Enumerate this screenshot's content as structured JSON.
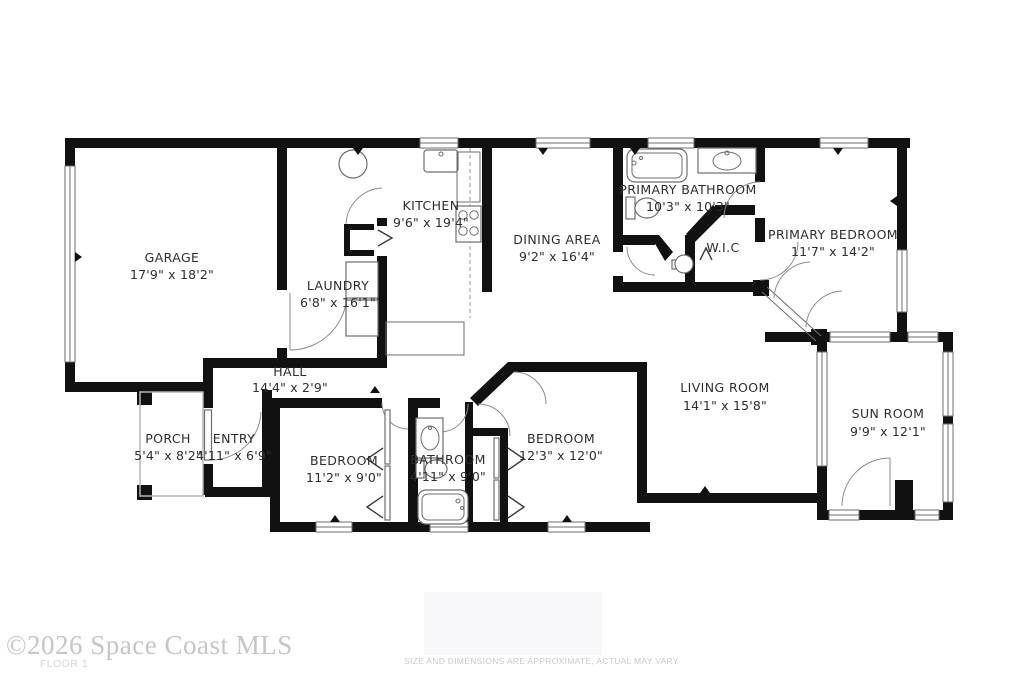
{
  "rooms": [
    {
      "name": "GARAGE",
      "dimensions": "17'9\" x 18'2\""
    },
    {
      "name": "LAUNDRY",
      "dimensions": "6'8\" x 16'1\""
    },
    {
      "name": "KITCHEN",
      "dimensions": "9'6\" x 19'4\""
    },
    {
      "name": "DINING AREA",
      "dimensions": "9'2\" x 16'4\""
    },
    {
      "name": "PRIMARY BATHROOM",
      "dimensions": "10'3\" x 10'3\""
    },
    {
      "name": "W.I.C",
      "dimensions": ""
    },
    {
      "name": "PRIMARY BEDROOM",
      "dimensions": "11'7\" x 14'2\""
    },
    {
      "name": "HALL",
      "dimensions": "14'4\" x 2'9\""
    },
    {
      "name": "PORCH",
      "dimensions": "5'4\" x 8'2\""
    },
    {
      "name": "ENTRY",
      "dimensions": "4'11\" x 6'9\""
    },
    {
      "name": "BEDROOM",
      "dimensions": "11'2\" x 9'0\""
    },
    {
      "name": "BATHROOM",
      "dimensions": "4'11\" x 9'0\""
    },
    {
      "name": "BEDROOM",
      "dimensions": "12'3\" x 12'0\""
    },
    {
      "name": "LIVING ROOM",
      "dimensions": "14'1\" x 15'8\""
    },
    {
      "name": "SUN ROOM",
      "dimensions": "9'9\" x 12'1\""
    }
  ],
  "footer": {
    "copyright": "©2026 Space Coast MLS",
    "floor_label": "FLOOR 1",
    "disclaimer": "SIZE AND DIMENSIONS ARE APPROXIMATE, ACTUAL MAY VARY"
  },
  "colors": {
    "wall": "#111111",
    "label_text": "#2e2e2e",
    "door_arc": "#8c8c8c",
    "fixture_outline": "#6e6e6e",
    "footer_text": "#c6c6c6"
  }
}
